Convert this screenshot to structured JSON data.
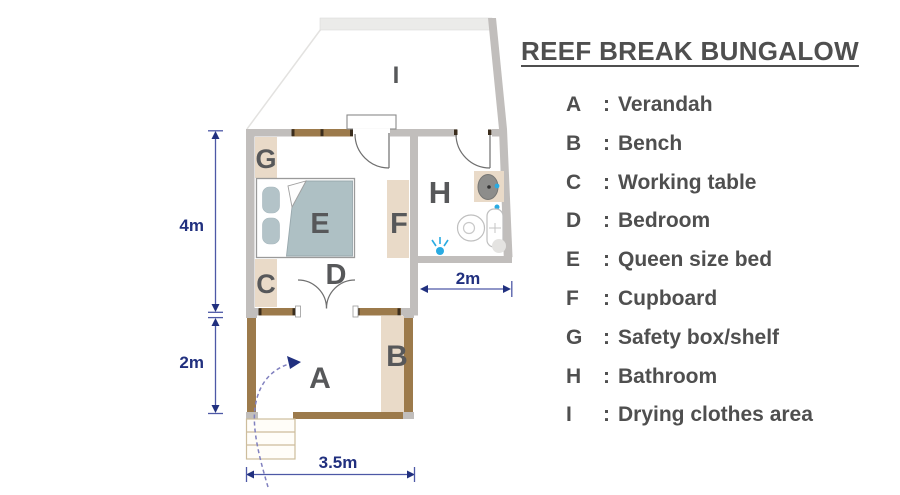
{
  "title": "REEF BREAK BUNGALOW",
  "legend": {
    "colon": ":",
    "items": [
      {
        "letter": "A",
        "name": "Verandah"
      },
      {
        "letter": "B",
        "name": "Bench"
      },
      {
        "letter": "C",
        "name": "Working table"
      },
      {
        "letter": "D",
        "name": "Bedroom"
      },
      {
        "letter": "E",
        "name": "Queen size bed"
      },
      {
        "letter": "F",
        "name": "Cupboard"
      },
      {
        "letter": "G",
        "name": "Safety box/shelf"
      },
      {
        "letter": "H",
        "name": "Bathroom"
      },
      {
        "letter": "I",
        "name": "Drying clothes area"
      }
    ]
  },
  "plan": {
    "labels": {
      "verandah": "A",
      "bench": "B",
      "working_table": "C",
      "bedroom": "D",
      "bed": "E",
      "cupboard": "F",
      "safety_box": "G",
      "bathroom": "H",
      "drying_area": "I"
    },
    "icons": {
      "shower": "water-spray-icon",
      "toilet": "toilet-plan-icon",
      "sink": "sink-basin-icon",
      "stairs": "steps-icon",
      "entry": "dashed-entry-arrow-icon"
    }
  },
  "dimensions": {
    "bedroom_height": "4m",
    "verandah_height": "2m",
    "bathroom_width": "2m",
    "verandah_width": "3.5m"
  },
  "colors": {
    "wall_gray": "#c1bebc",
    "wall_light": "#ebebe9",
    "wood_brown": "#9c7a4b",
    "furniture_tan": "#e9dac8",
    "bed_blue_gray": "#aec0c4",
    "room_label": "#57585a",
    "dimension_navy": "#21307f",
    "water_blue": "#29abe2",
    "title_gray": "#4f4f4f"
  }
}
